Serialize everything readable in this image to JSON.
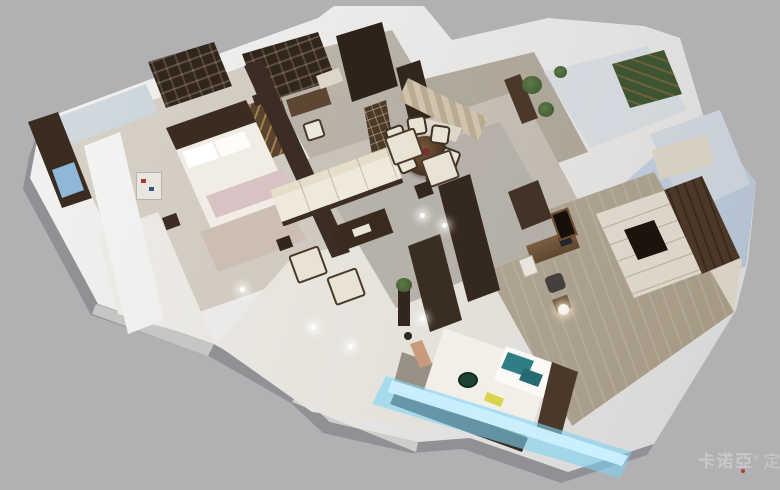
{
  "watermark": {
    "brand": "卡诺亞",
    "registered": "®",
    "suffix": "定制家"
  },
  "palette": {
    "bg": "#b1b1b3",
    "slab": "#eeedeb",
    "dark_wood": "#3a2c21",
    "mid_wood": "#6b5238",
    "cream": "#e9e3d4",
    "floor_warm": "#c8c1b7",
    "rug": "#b5b0a8",
    "marble": "#efece7",
    "wood_floor": "#b3a899",
    "mural": "#bfccd3",
    "blue_wall": "#c6d1de",
    "teal": "#2e7e86",
    "led": "#cdf1ff",
    "plant": "#4a6239",
    "carpet_pink": "#d9c2c4",
    "watermark": "#cacaca",
    "watermark_red": "#b23b2f"
  }
}
